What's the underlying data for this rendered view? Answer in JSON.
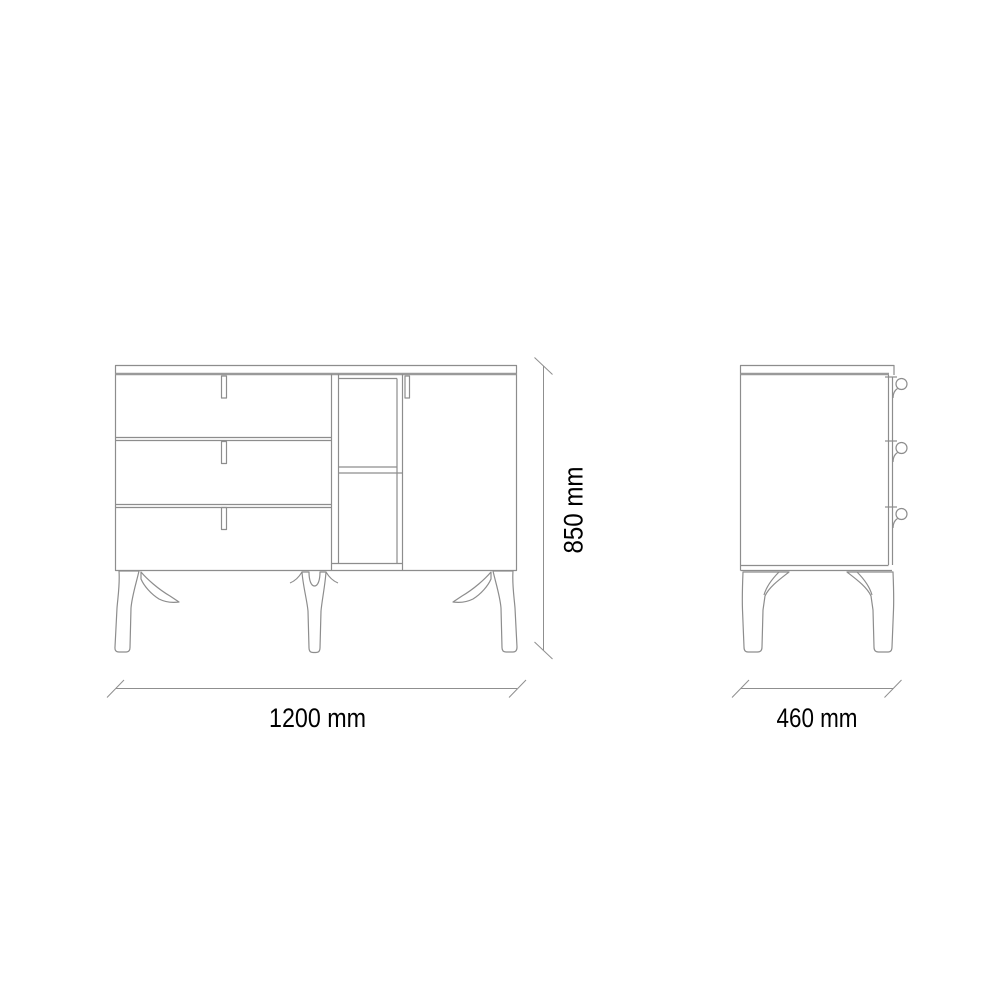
{
  "colors": {
    "background": "#ffffff",
    "line": "#8d8d8d",
    "line_heavy": "#9a9a9a",
    "dimension": "#8f8f8f",
    "text": "#000000"
  },
  "dimensions": {
    "width": {
      "label": "1200 mm"
    },
    "height": {
      "label": "850 mm"
    },
    "depth": {
      "label": "460 mm"
    }
  }
}
